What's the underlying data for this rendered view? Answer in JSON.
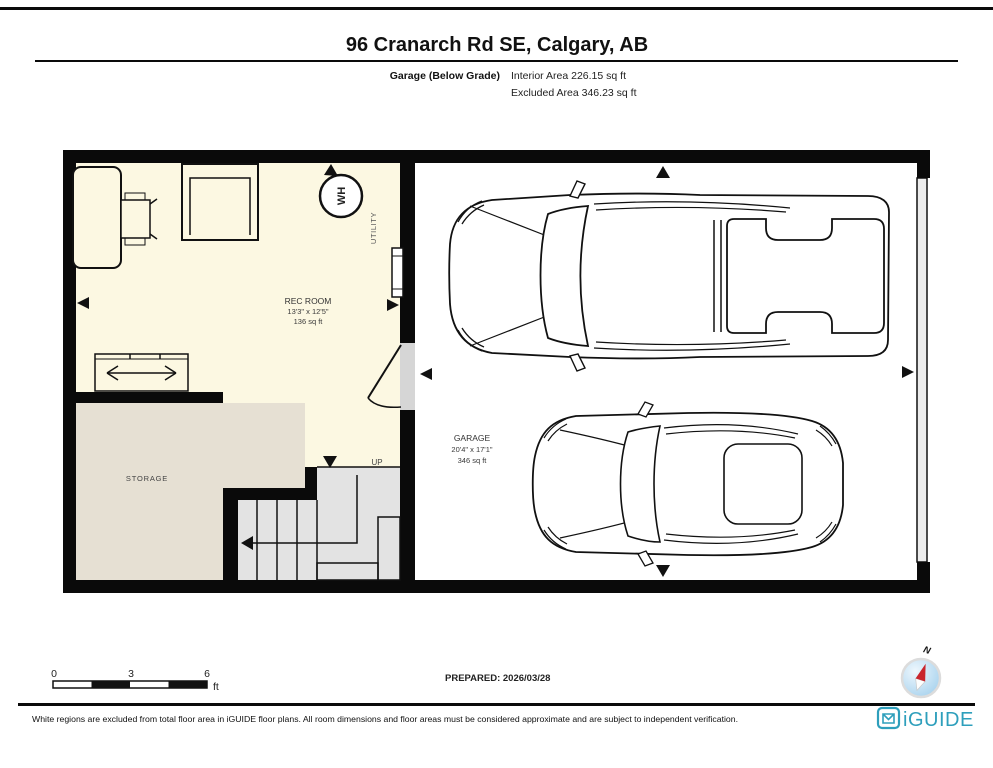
{
  "page": {
    "title": "96 Cranarch Rd SE, Calgary, AB",
    "floor_label": "Garage (Below Grade)",
    "interior_area": "Interior Area 226.15 sq ft",
    "excluded_area": "Excluded Area 346.23 sq ft"
  },
  "rooms": {
    "rec_room": {
      "name": "REC ROOM",
      "dimensions": "13'3\" x 12'5\"",
      "area": "136 sq ft"
    },
    "garage": {
      "name": "GARAGE",
      "dimensions": "20'4\" x 17'1\"",
      "area": "346 sq ft"
    },
    "storage": {
      "name": "STORAGE"
    },
    "utility": {
      "name": "UTILITY"
    }
  },
  "labels": {
    "water_heater": "WH",
    "stairs_up": "UP"
  },
  "scale_bar": {
    "ticks": [
      "0",
      "3",
      "6"
    ],
    "unit": "ft"
  },
  "prepared": {
    "text": "PREPARED: 2026/03/28"
  },
  "compass": {
    "north": "N"
  },
  "footer": {
    "disclaimer": "White regions are excluded from total floor area in iGUIDE floor plans. All room dimensions and floor areas must be considered approximate and are subject to independent verification.",
    "brand": "iGUIDE"
  },
  "colors": {
    "wall": "#0a0a0a",
    "room_fill": "#fcf8e2",
    "storage_fill": "#e6e0d3",
    "stairs_fill": "#e3e3e3",
    "door_gap": "#d6d6d6",
    "garage_door": "#ececec",
    "brand_teal": "#2e9fbc",
    "compass_blue": "#a9d3ee",
    "compass_red": "#c9252c"
  }
}
